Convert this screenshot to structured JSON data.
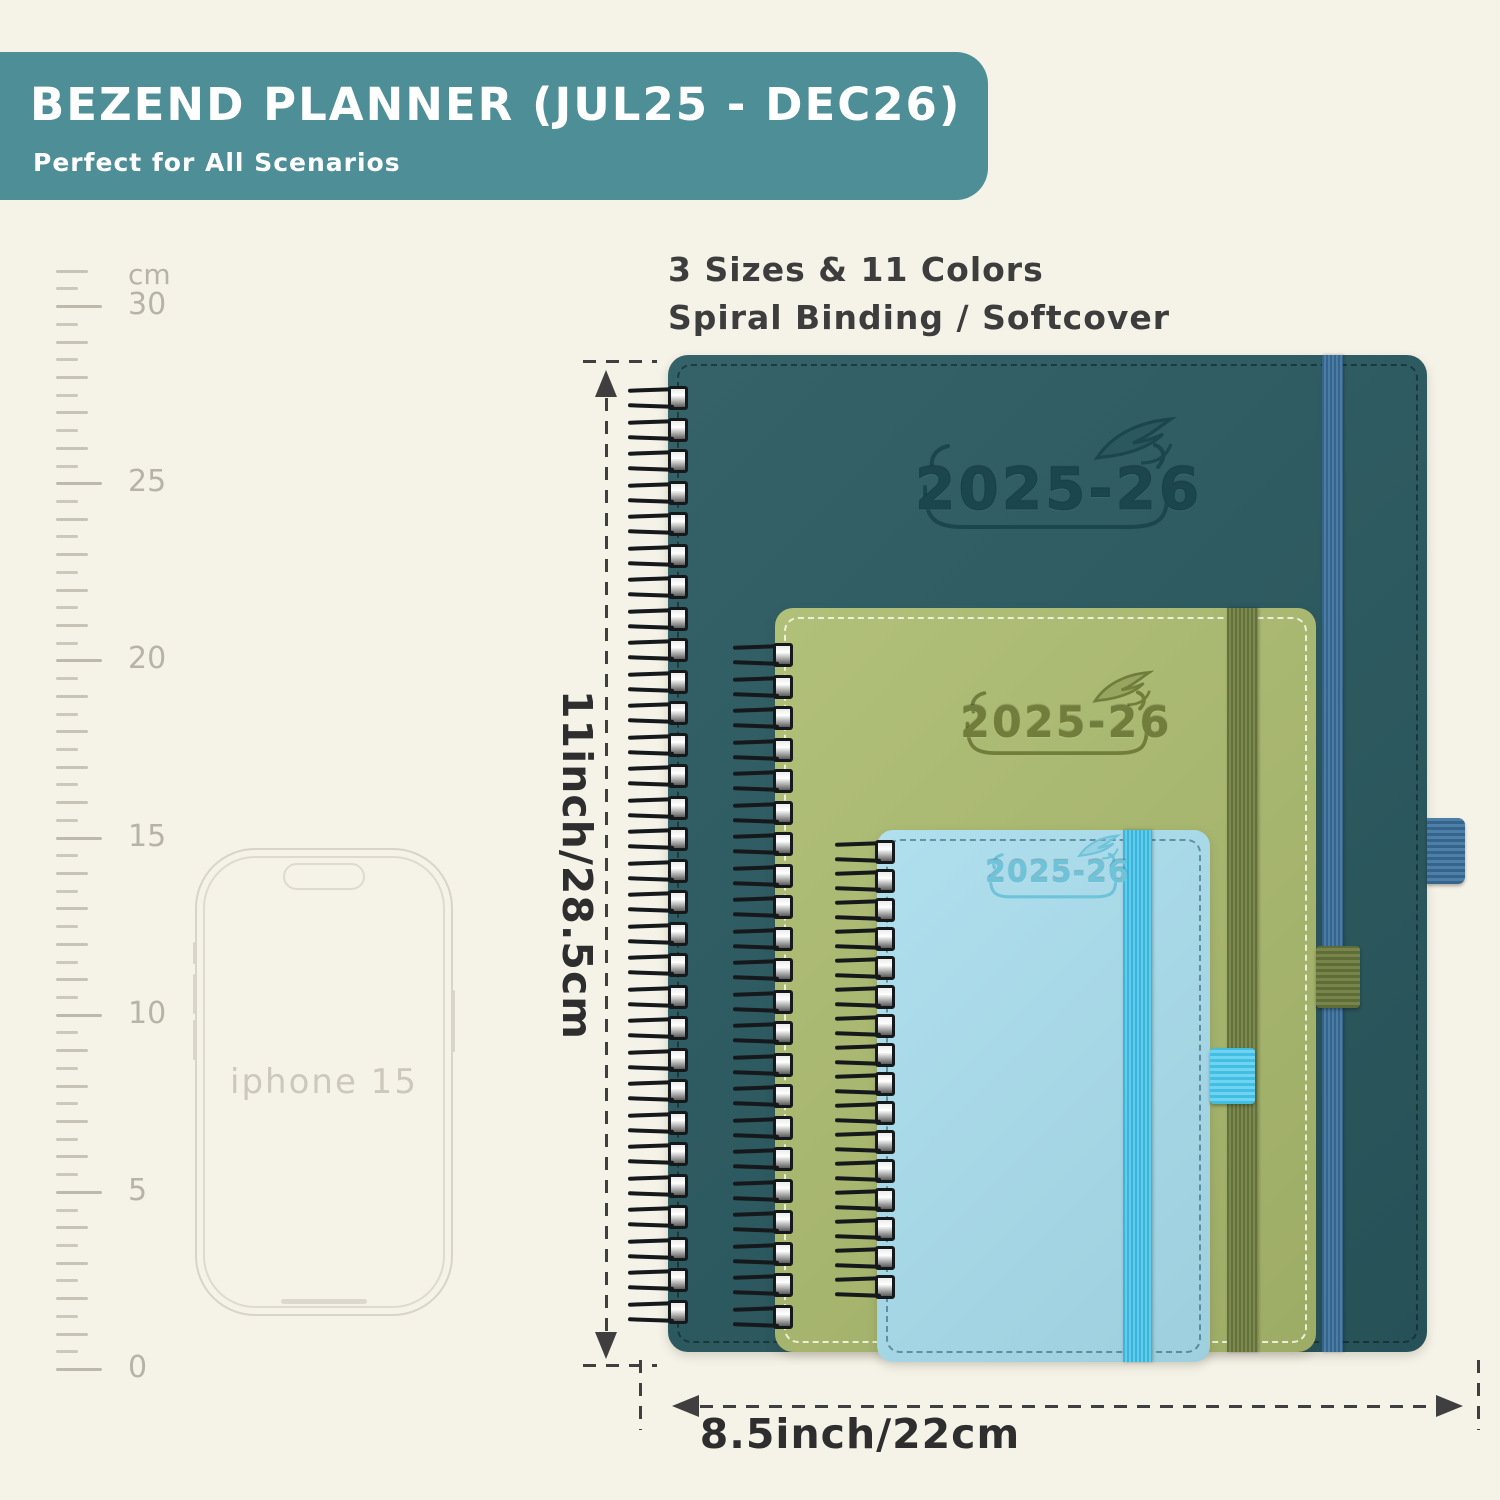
{
  "banner": {
    "title": "BEZEND PLANNER (JUL25 - DEC26)",
    "subtitle": "Perfect for All Scenarios",
    "bg_color": "#4e8e96",
    "text_color": "#ffffff"
  },
  "features": {
    "line1": "3 Sizes & 11 Colors",
    "line2": "Spiral Binding / Softcover"
  },
  "ruler": {
    "unit": "cm",
    "labels": [
      "30",
      "25",
      "20",
      "15",
      "10",
      "5",
      "0"
    ]
  },
  "phone": {
    "label": "iphone 15"
  },
  "planners": {
    "large": {
      "year": "2025-26",
      "cover_color": "#2a5a61",
      "band_color": "#3f6f92"
    },
    "medium": {
      "year": "2025-26",
      "cover_color": "#abbb6e",
      "band_color": "#6f7c44"
    },
    "small": {
      "year": "2025-26",
      "cover_color": "#a7dcec",
      "band_color": "#49c0e3"
    }
  },
  "dimensions": {
    "height_label": "11inch/28.5cm",
    "width_label": "8.5inch/22cm"
  },
  "background_color": "#f5f2e7"
}
